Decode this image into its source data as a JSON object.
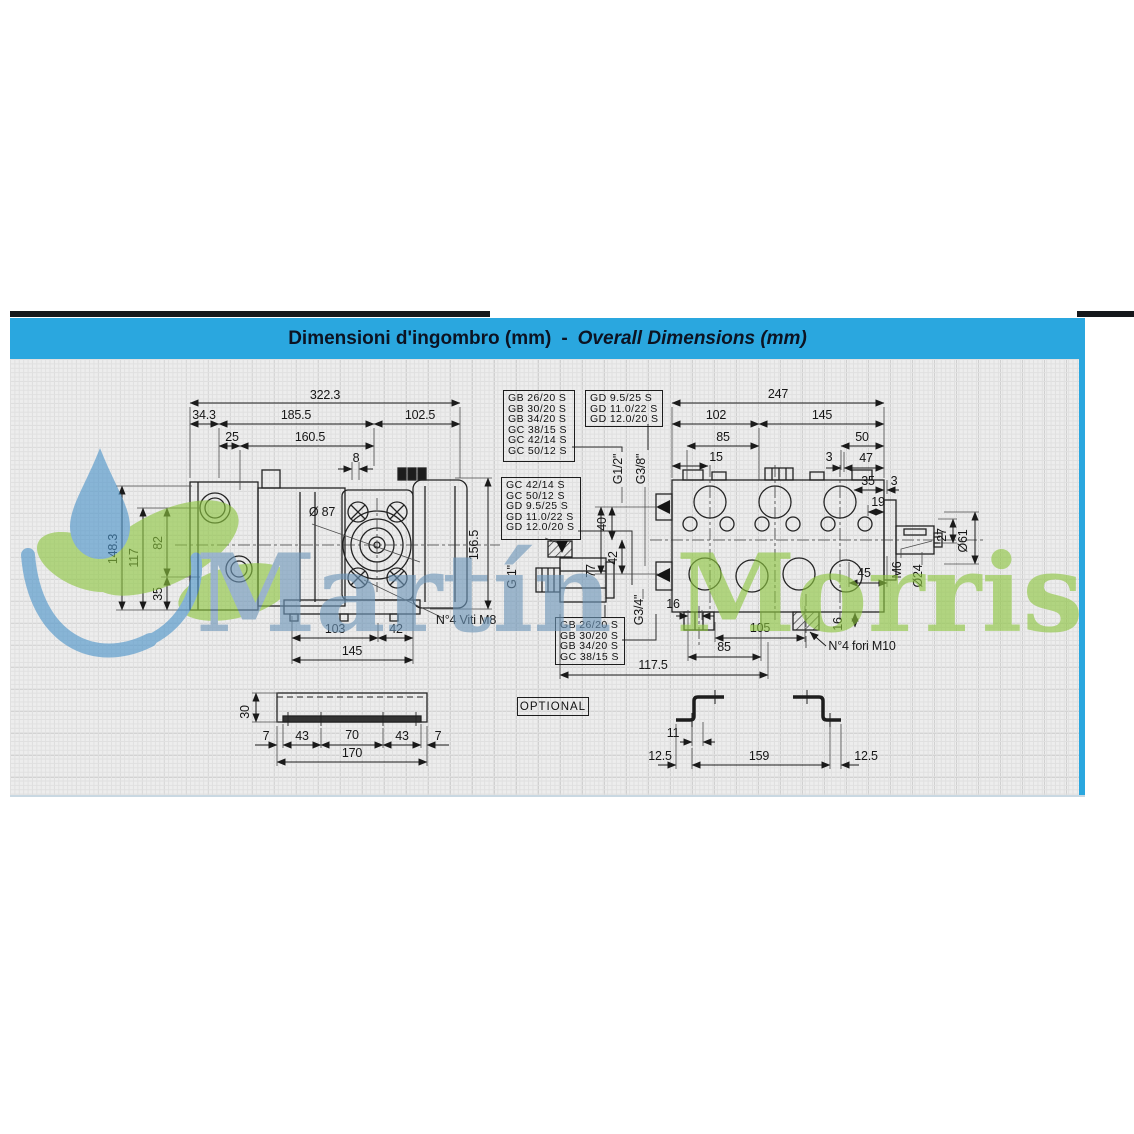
{
  "title": {
    "italian": "Dimensioni d'ingombro (mm)",
    "separator": "-",
    "english": "Overall Dimensions (mm)"
  },
  "watermark": {
    "first": "Martín",
    "last": "Morris"
  },
  "tables": {
    "top_left": {
      "rows": [
        "GB 26/20 S",
        "GB 30/20 S",
        "GB 34/20 S",
        "GC 38/15 S",
        "GC 42/14 S",
        "GC 50/12 S"
      ]
    },
    "top_right": {
      "rows": [
        "GD 9.5/25 S",
        "GD 11.0/22 S",
        "GD 12.0/20 S"
      ]
    },
    "mid_left": {
      "rows": [
        "GC 42/14 S",
        "GC 50/12 S",
        "GD 9.5/25 S",
        "GD 11.0/22 S",
        "GD 12.0/20 S"
      ]
    },
    "bottom": {
      "rows": [
        "GB 26/20 S",
        "GB 30/20 S",
        "GB 34/20 S",
        "GC 38/15 S"
      ]
    }
  },
  "side_view": {
    "overall_width": "322.3",
    "left_offset": "34.3",
    "mid_width": "185.5",
    "right_width": "102.5",
    "dim_25": "25",
    "dim_160_5": "160.5",
    "dim_8": "8",
    "height_total": "148.3",
    "dim_117": "117",
    "dim_82": "82",
    "dim_35": "35",
    "height_right": "156.5",
    "dim_103": "103",
    "dim_42": "42",
    "dim_145": "145",
    "flange_diameter": "Ø 87",
    "screws_note": "N°4 Viti M8",
    "inlet_port": "G 1\""
  },
  "front_view": {
    "overall_width": "247",
    "dim_102": "102",
    "dim_145": "145",
    "dim_85_top": "85",
    "dim_50": "50",
    "dim_15": "15",
    "dim_3_top": "3",
    "dim_47": "47",
    "dim_35": "35",
    "dim_3_right": "3",
    "dim_19": "19",
    "dim_40": "40",
    "dim_42": "42",
    "dim_77": "77",
    "port_left_top": "G1/2\"",
    "port_left_bottom": "G3/8\"",
    "port_bottom": "G3/4\"",
    "dim_16_left": "16",
    "dim_105": "105",
    "dim_85_bottom": "85",
    "dim_117_5": "117.5",
    "dim_16_right": "16",
    "holes_note": "N°4 fori M10",
    "dim_45": "45",
    "thread_m6": "M6",
    "dim_o24": "Ø24",
    "dim_27": "27",
    "dim_o61": "Ø61"
  },
  "channel": {
    "dim_30": "30",
    "dim_7_left": "7",
    "dim_43_left": "43",
    "dim_70": "70",
    "dim_43_right": "43",
    "dim_7_right": "7",
    "dim_170": "170"
  },
  "optional": {
    "label": "OPTIONAL"
  },
  "bracket": {
    "dim_11": "11",
    "dim_12_5_left": "12.5",
    "dim_159": "159",
    "dim_12_5_right": "12.5"
  }
}
